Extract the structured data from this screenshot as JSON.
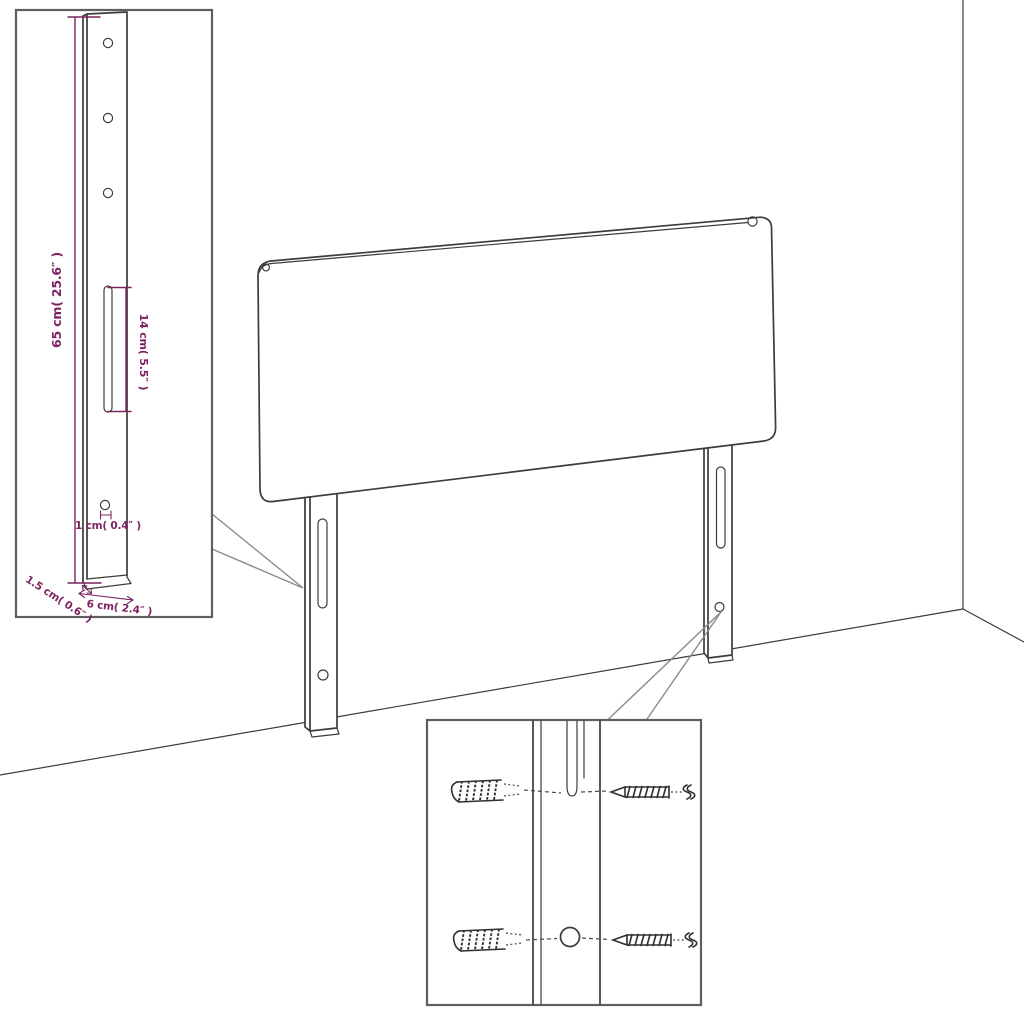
{
  "diagram": {
    "type": "furniture-dimension-diagram",
    "subject": "headboard with two mounting legs in a room corner",
    "colors": {
      "dimension_accent": "#7c2462",
      "drawing_line": "#3c3c3c",
      "background": "#ffffff"
    },
    "detail_inset": {
      "labels": {
        "bracket_height": "65 cm( 25.6″ )",
        "slot_length": "14 cm( 5.5″ )",
        "hole_diameter": "1 cm( 0.4″ )",
        "bracket_thickness": "1.5 cm( 0.6″ )",
        "bracket_width": "6 cm( 2.4″ )"
      }
    },
    "hardware_inset": {
      "icons": [
        "wall-plug-icon",
        "wall-plug-icon",
        "screw-icon",
        "screw-icon"
      ]
    }
  }
}
